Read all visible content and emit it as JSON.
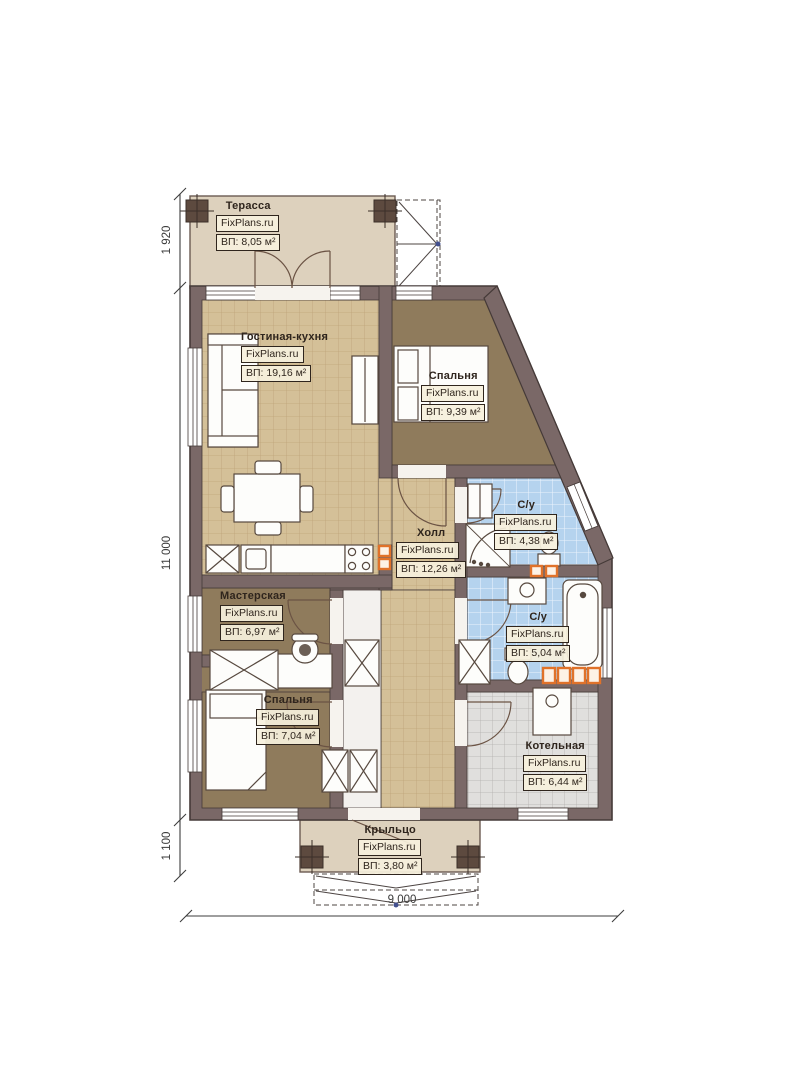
{
  "plan": {
    "brand": "FixPlans.ru",
    "rooms": [
      {
        "id": "terrace",
        "name": "Терасса",
        "area": "ВП: 8,05 м²"
      },
      {
        "id": "living",
        "name": "Гостиная-кухня",
        "area": "ВП: 19,16 м²"
      },
      {
        "id": "bedroom1",
        "name": "Спальня",
        "area": "ВП: 9,39 м²"
      },
      {
        "id": "bath1",
        "name": "С/у",
        "area": "ВП: 4,38 м²"
      },
      {
        "id": "hall",
        "name": "Холл",
        "area": "ВП: 12,26 м²"
      },
      {
        "id": "workshop",
        "name": "Мастерская",
        "area": "ВП: 6,97 м²"
      },
      {
        "id": "bath2",
        "name": "С/у",
        "area": "ВП: 5,04 м²"
      },
      {
        "id": "bedroom2",
        "name": "Спальня",
        "area": "ВП: 7,04 м²"
      },
      {
        "id": "boiler",
        "name": "Котельная",
        "area": "ВП: 6,44 м²"
      },
      {
        "id": "porch",
        "name": "Крыльцо",
        "area": "ВП: 3,80 м²"
      }
    ],
    "dimensions": {
      "left_top": "1 920",
      "left_main": "11 000",
      "left_bottom": "1 100",
      "bottom_width": "9 000"
    },
    "colors": {
      "wall": "#7a6867",
      "terrace_floor": "#ddd1bd",
      "tile_tan": "#d4c098",
      "floor_brown": "#8f7b5c",
      "tile_blue": "#b5d3ee",
      "tile_gray": "#e0dfdd",
      "accent_orange": "#e0722a"
    }
  }
}
